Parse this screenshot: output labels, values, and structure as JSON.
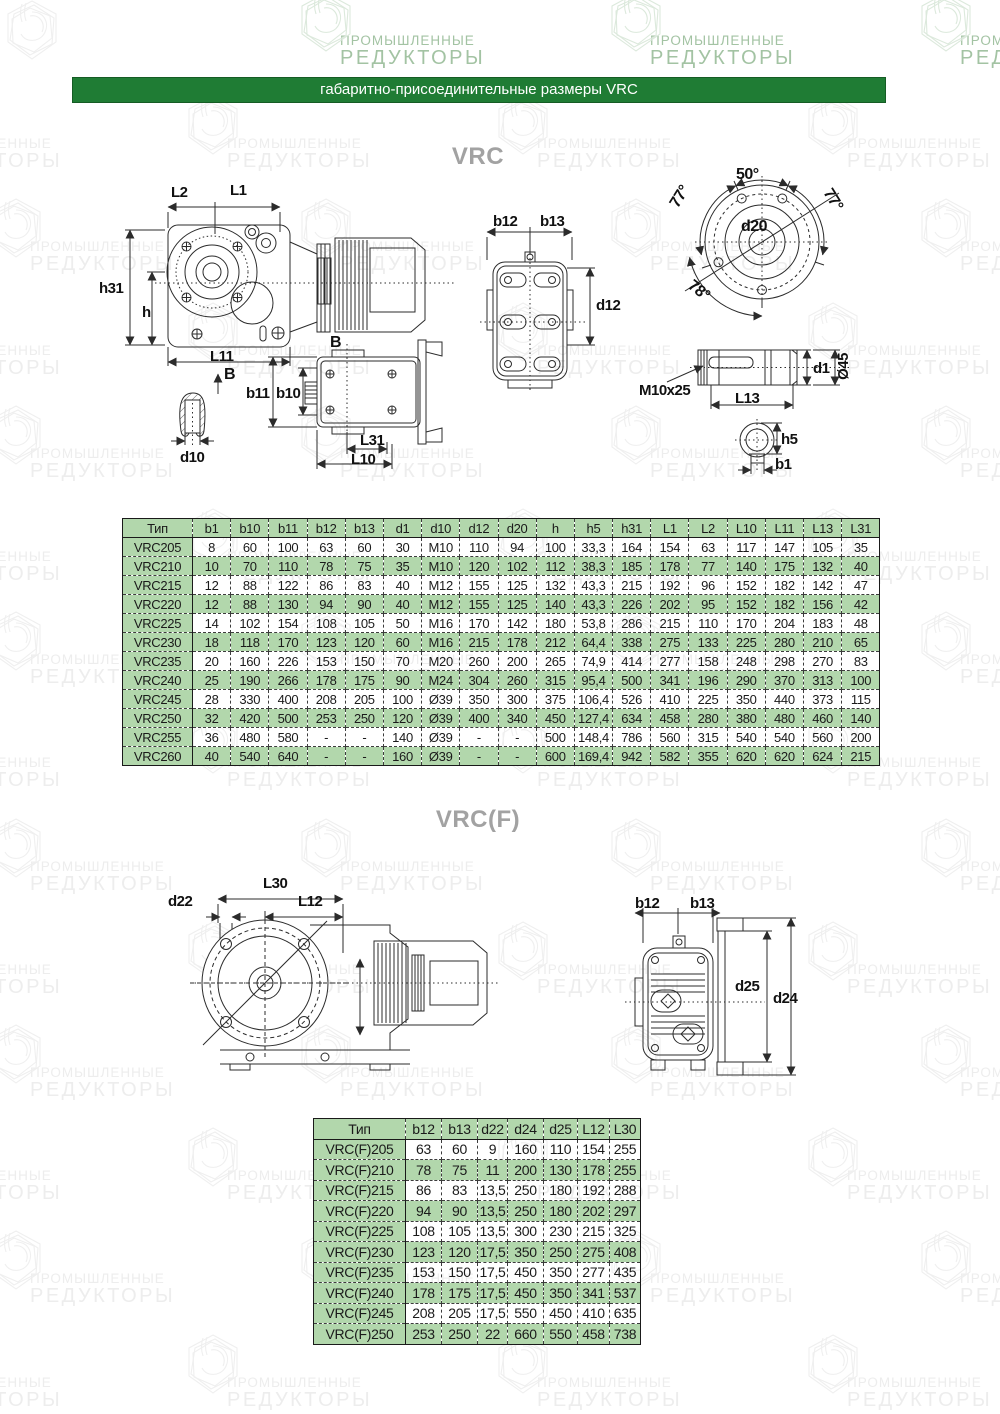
{
  "header": {
    "title": "габаритно-присоединительные размеры VRC"
  },
  "sections": {
    "vrc_title": "VRC",
    "vrcf_title": "VRC(F)"
  },
  "watermark": {
    "line1": "ПРОМЫШЛЕННЫЕ",
    "line2": "РЕДУКТОРЫ"
  },
  "colors": {
    "header_bar_green": "#1f7c34",
    "table_green": "#b2d7ac",
    "title_gray": "#a2a2a2",
    "watermark_gray": "#ededed",
    "watermark_green": "#a3c3a3"
  },
  "drawings": {
    "vrc_side": {
      "l2": "L2",
      "l1": "L1",
      "h31": "h31",
      "h": "h",
      "l11": "L11",
      "b": "B"
    },
    "vrc_rear": {
      "b12": "b12",
      "b13": "b13",
      "d12": "d12"
    },
    "vrc_flange": {
      "a50": "50°",
      "a77_left": "77°",
      "a77_right": "77°",
      "a78": "78°",
      "d20": "d20"
    },
    "vrc_shaft": {
      "thread": "M10x25",
      "l13": "L13",
      "d1": "d1",
      "dia45": "Ø45"
    },
    "vrc_key": {
      "d10": "d10"
    },
    "vrc_bb": {
      "b": "B",
      "b11": "b11",
      "b10": "b10",
      "l31": "L31",
      "l10": "L10"
    },
    "vrc_shaft_section": {
      "h5": "h5",
      "b1": "b1"
    },
    "vrcf_left": {
      "l30": "L30",
      "d22": "d22",
      "l12": "L12"
    },
    "vrcf_rear": {
      "b12": "b12",
      "b13": "b13",
      "d25": "d25",
      "d24": "d24"
    }
  },
  "table_vrc": {
    "columns": [
      "Тип",
      "b1",
      "b10",
      "b11",
      "b12",
      "b13",
      "d1",
      "d10",
      "d12",
      "d20",
      "h",
      "h5",
      "h31",
      "L1",
      "L2",
      "L10",
      "L11",
      "L13",
      "L31"
    ],
    "rows": [
      [
        "VRC205",
        "8",
        "60",
        "100",
        "63",
        "60",
        "30",
        "M10",
        "110",
        "94",
        "100",
        "33,3",
        "164",
        "154",
        "63",
        "117",
        "147",
        "105",
        "35"
      ],
      [
        "VRC210",
        "10",
        "70",
        "110",
        "78",
        "75",
        "35",
        "M10",
        "120",
        "102",
        "112",
        "38,3",
        "185",
        "178",
        "77",
        "140",
        "175",
        "132",
        "40"
      ],
      [
        "VRC215",
        "12",
        "88",
        "122",
        "86",
        "83",
        "40",
        "M12",
        "155",
        "125",
        "132",
        "43,3",
        "215",
        "192",
        "96",
        "152",
        "182",
        "142",
        "47"
      ],
      [
        "VRC220",
        "12",
        "88",
        "130",
        "94",
        "90",
        "40",
        "M12",
        "155",
        "125",
        "140",
        "43,3",
        "226",
        "202",
        "95",
        "152",
        "182",
        "156",
        "42"
      ],
      [
        "VRC225",
        "14",
        "102",
        "154",
        "108",
        "105",
        "50",
        "M16",
        "170",
        "142",
        "180",
        "53,8",
        "286",
        "215",
        "110",
        "170",
        "204",
        "183",
        "48"
      ],
      [
        "VRC230",
        "18",
        "118",
        "170",
        "123",
        "120",
        "60",
        "M16",
        "215",
        "178",
        "212",
        "64,4",
        "338",
        "275",
        "133",
        "225",
        "280",
        "210",
        "65"
      ],
      [
        "VRC235",
        "20",
        "160",
        "226",
        "153",
        "150",
        "70",
        "M20",
        "260",
        "200",
        "265",
        "74,9",
        "414",
        "277",
        "158",
        "248",
        "298",
        "270",
        "83"
      ],
      [
        "VRC240",
        "25",
        "190",
        "266",
        "178",
        "175",
        "90",
        "M24",
        "304",
        "260",
        "315",
        "95,4",
        "500",
        "341",
        "196",
        "290",
        "370",
        "313",
        "100"
      ],
      [
        "VRC245",
        "28",
        "330",
        "400",
        "208",
        "205",
        "100",
        "Ø39",
        "350",
        "300",
        "375",
        "106,4",
        "526",
        "410",
        "225",
        "350",
        "440",
        "373",
        "115"
      ],
      [
        "VRC250",
        "32",
        "420",
        "500",
        "253",
        "250",
        "120",
        "Ø39",
        "400",
        "340",
        "450",
        "127,4",
        "634",
        "458",
        "280",
        "380",
        "480",
        "460",
        "140"
      ],
      [
        "VRC255",
        "36",
        "480",
        "580",
        "-",
        "-",
        "140",
        "Ø39",
        "-",
        "-",
        "500",
        "148,4",
        "786",
        "560",
        "315",
        "540",
        "540",
        "560",
        "200"
      ],
      [
        "VRC260",
        "40",
        "540",
        "640",
        "-",
        "-",
        "160",
        "Ø39",
        "-",
        "-",
        "600",
        "169,4",
        "942",
        "582",
        "355",
        "620",
        "620",
        "624",
        "215"
      ]
    ]
  },
  "table_vrcf": {
    "columns": [
      "Тип",
      "b12",
      "b13",
      "d22",
      "d24",
      "d25",
      "L12",
      "L30"
    ],
    "rows": [
      [
        "VRC(F)205",
        "63",
        "60",
        "9",
        "160",
        "110",
        "154",
        "255"
      ],
      [
        "VRC(F)210",
        "78",
        "75",
        "11",
        "200",
        "130",
        "178",
        "255"
      ],
      [
        "VRC(F)215",
        "86",
        "83",
        "13,5",
        "250",
        "180",
        "192",
        "288"
      ],
      [
        "VRC(F)220",
        "94",
        "90",
        "13,5",
        "250",
        "180",
        "202",
        "297"
      ],
      [
        "VRC(F)225",
        "108",
        "105",
        "13,5",
        "300",
        "230",
        "215",
        "325"
      ],
      [
        "VRC(F)230",
        "123",
        "120",
        "17,5",
        "350",
        "250",
        "275",
        "408"
      ],
      [
        "VRC(F)235",
        "153",
        "150",
        "17,5",
        "450",
        "350",
        "277",
        "435"
      ],
      [
        "VRC(F)240",
        "178",
        "175",
        "17,5",
        "450",
        "350",
        "341",
        "537"
      ],
      [
        "VRC(F)245",
        "208",
        "205",
        "17,5",
        "550",
        "450",
        "410",
        "635"
      ],
      [
        "VRC(F)250",
        "253",
        "250",
        "22",
        "660",
        "550",
        "458",
        "738"
      ]
    ]
  }
}
